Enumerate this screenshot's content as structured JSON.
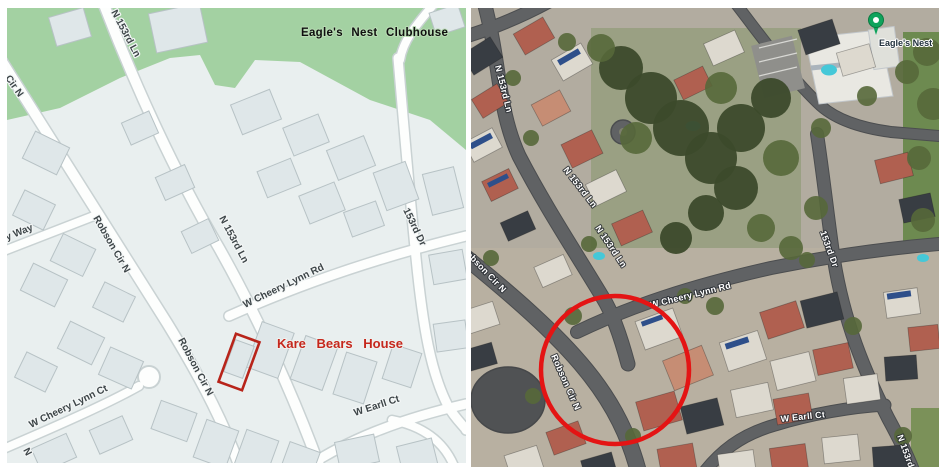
{
  "left_map": {
    "clubhouse_label": "Eagle's Nest Clubhouse",
    "highlight_label": "Kare Bears House",
    "highlight_color": "#c5271c",
    "parcel_outline_color": "#b8241a",
    "park_color": "#a3d1a2",
    "road_color": "#fdfefd",
    "block_color": "#e9efef",
    "building_color": "#dfe7e9",
    "street_labels": [
      "N 153rd Ln",
      "Cir N",
      "Monterey Way",
      "Robson Cir N",
      "N 153rd Ln",
      "W Cheery Lynn Rd",
      "153rd Dr",
      "Robson Cir N",
      "W Cheery Lynn Ct",
      "W Earll Ct",
      "N"
    ]
  },
  "satellite_map": {
    "pin_label": "Eagle's Nest",
    "pin_color": "#0fa35c",
    "circle_color": "#e41414",
    "street_labels": [
      "N 153rd Ln",
      "N 153rd Ln",
      "N 153rd Ln",
      "Robson Cir N",
      "Robson Cir N",
      "W Cheery Lynn Rd",
      "153rd Dr",
      "W Earll Ct",
      "N 153rd"
    ]
  }
}
